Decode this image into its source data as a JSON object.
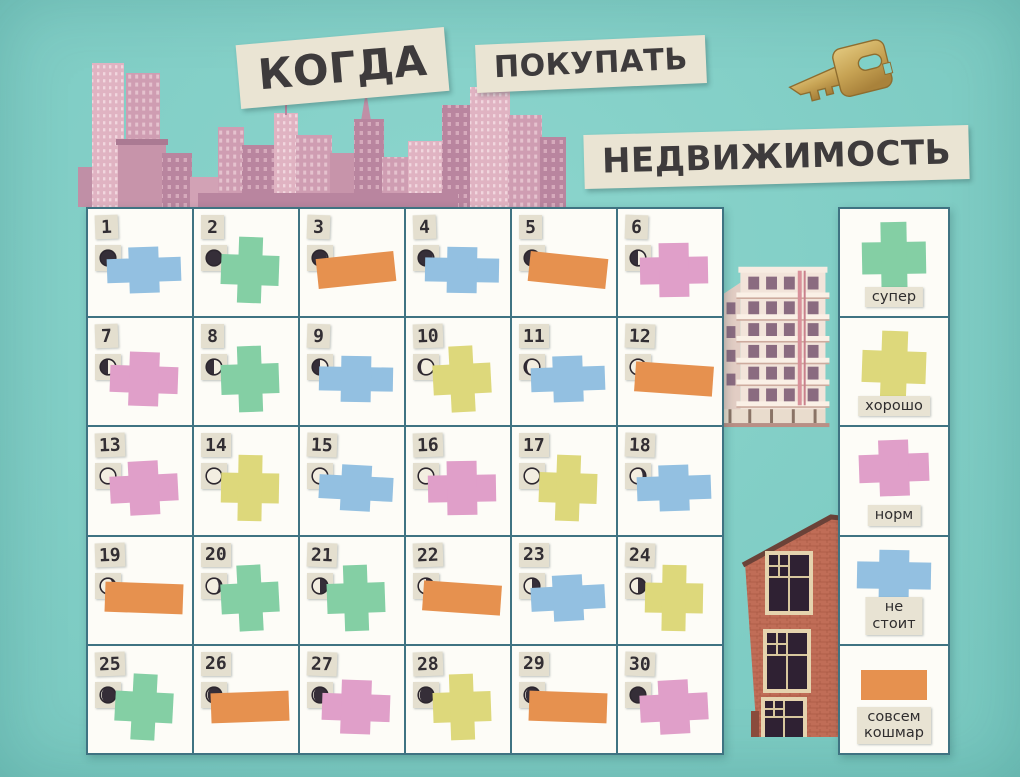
{
  "title": {
    "word1": "КОГДА",
    "word2": "ПОКУПАТЬ",
    "word3": "НЕДВИЖИМОСТЬ"
  },
  "icons": {
    "key": "golden-key",
    "skyline": "pink-city-skyline",
    "hotel": "white-deco-building",
    "house": "red-brick-house",
    "moon": "moon-phase"
  },
  "colors": {
    "background": "#80d1c8",
    "grid_line": "#3f7382",
    "cell_bg": "#fdfcf7",
    "tile_bg": "#e4dfcf",
    "ink": "#3e3b3c",
    "moon_dark": "#352e38",
    "moon_light": "#f3eee1",
    "ratings": {
      "super": "#84cfa4",
      "good": "#ddd87b",
      "norm": "#e09fc9",
      "ne_stoit": "#93c0e1",
      "koshmar": "#e6914f"
    }
  },
  "rating_shapes": {
    "super": "cross",
    "good": "cross",
    "norm": "cross-flat",
    "ne_stoit": "cross-wide",
    "koshmar": "rect"
  },
  "legend": {
    "items": [
      {
        "rating": "super",
        "label": "супер"
      },
      {
        "rating": "good",
        "label": "хорошо"
      },
      {
        "rating": "norm",
        "label": "норм"
      },
      {
        "rating": "ne_stoit",
        "label": "не стоит"
      },
      {
        "rating": "koshmar",
        "label": "совсем кошмар"
      }
    ]
  },
  "calendar": {
    "days": [
      {
        "day": 1,
        "moon": "new",
        "rating": "ne_stoit"
      },
      {
        "day": 2,
        "moon": "new",
        "rating": "super"
      },
      {
        "day": 3,
        "moon": "waxing-crescent",
        "rating": "koshmar"
      },
      {
        "day": 4,
        "moon": "waxing-crescent",
        "rating": "ne_stoit"
      },
      {
        "day": 5,
        "moon": "waxing-crescent",
        "rating": "koshmar"
      },
      {
        "day": 6,
        "moon": "first-quarter",
        "rating": "norm"
      },
      {
        "day": 7,
        "moon": "first-quarter",
        "rating": "norm"
      },
      {
        "day": 8,
        "moon": "first-quarter",
        "rating": "super"
      },
      {
        "day": 9,
        "moon": "first-quarter",
        "rating": "ne_stoit"
      },
      {
        "day": 10,
        "moon": "waxing-gibbous",
        "rating": "good"
      },
      {
        "day": 11,
        "moon": "waxing-gibbous",
        "rating": "ne_stoit"
      },
      {
        "day": 12,
        "moon": "full",
        "rating": "koshmar"
      },
      {
        "day": 13,
        "moon": "full",
        "rating": "norm"
      },
      {
        "day": 14,
        "moon": "full",
        "rating": "good"
      },
      {
        "day": 15,
        "moon": "full",
        "rating": "ne_stoit"
      },
      {
        "day": 16,
        "moon": "full",
        "rating": "norm"
      },
      {
        "day": 17,
        "moon": "full",
        "rating": "good"
      },
      {
        "day": 18,
        "moon": "waning-gibbous",
        "rating": "ne_stoit"
      },
      {
        "day": 19,
        "moon": "waning-gibbous",
        "rating": "koshmar"
      },
      {
        "day": 20,
        "moon": "waning-gibbous",
        "rating": "super"
      },
      {
        "day": 21,
        "moon": "last-quarter",
        "rating": "super"
      },
      {
        "day": 22,
        "moon": "last-quarter",
        "rating": "koshmar"
      },
      {
        "day": 23,
        "moon": "last-quarter",
        "rating": "ne_stoit"
      },
      {
        "day": 24,
        "moon": "last-quarter",
        "rating": "good"
      },
      {
        "day": 25,
        "moon": "waning-crescent",
        "rating": "super"
      },
      {
        "day": 26,
        "moon": "waning-crescent",
        "rating": "koshmar"
      },
      {
        "day": 27,
        "moon": "waning-crescent",
        "rating": "norm"
      },
      {
        "day": 28,
        "moon": "waning-crescent",
        "rating": "good"
      },
      {
        "day": 29,
        "moon": "waning-crescent",
        "rating": "koshmar"
      },
      {
        "day": 30,
        "moon": "new",
        "rating": "norm"
      }
    ]
  }
}
